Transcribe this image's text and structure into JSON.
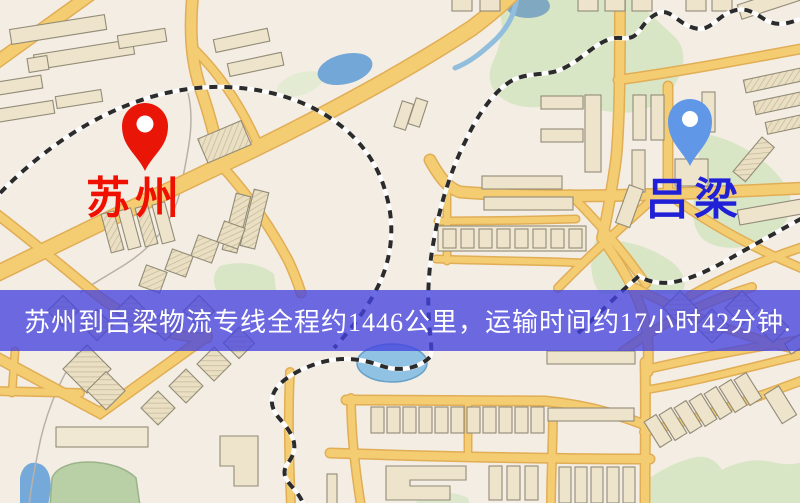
{
  "banner": {
    "text": "苏州到吕梁物流专线全程约1446公里，运输时间约17小时42分钟.",
    "bg_color": "#4442df",
    "text_color": "#ffffff"
  },
  "markers": {
    "origin": {
      "label": "苏州",
      "pin_color": "#ee1506",
      "label_color": "#f01000"
    },
    "destination": {
      "label": "吕梁",
      "pin_color": "#5e97ea",
      "label_color": "#2020d6"
    }
  },
  "route": {
    "distance_km": "1446",
    "duration": "17小时42分钟"
  },
  "map_colors": {
    "background": "#f3ede3",
    "road_fill": "#f5cd70",
    "road_casing": "#e2ad52",
    "building_fill": "#eee4cb",
    "building_outline": "#928b76",
    "park_green": "#d9e6c4",
    "water_blue": "#74a9dc",
    "railway_black": "#2b2b2b"
  }
}
